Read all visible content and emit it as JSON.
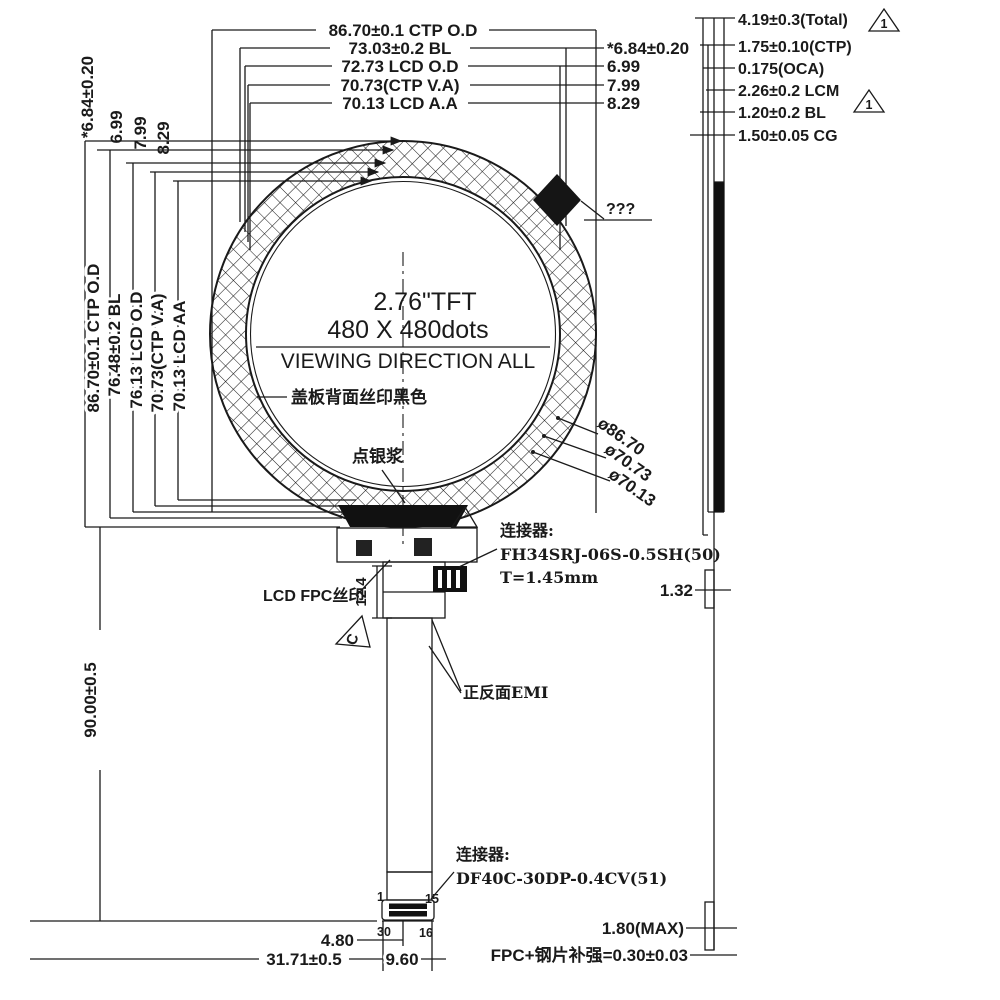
{
  "colors": {
    "ink": "#1a1a1a",
    "background": "#ffffff"
  },
  "front": {
    "top_dims": [
      "86.70±0.1 CTP O.D",
      "73.03±0.2 BL",
      "72.73 LCD O.D",
      "70.73(CTP V.A)",
      "70.13 LCD A.A"
    ],
    "right_offsets": [
      "*6.84±0.20",
      "6.99",
      "7.99",
      "8.29"
    ],
    "left_offsets": [
      "*6.84±0.20",
      "6.99",
      "7.99",
      "8.29"
    ],
    "left_dims": [
      "86.70±0.1 CTP O.D",
      "76.48±0.2 BL",
      "76.13 LCD O.D",
      "70.73(CTP V.A)",
      "70.13 LCD AA"
    ],
    "height_dim": "90.00±0.5",
    "display": {
      "size": "2.76\"TFT",
      "resolution": "480 X 480dots",
      "viewing_direction": "VIEWING DIRECTION ALL"
    },
    "notes": {
      "cover_print": "盖板背面丝印黑色",
      "silver_paste": "点银浆",
      "unknown": "???",
      "lcd_fpc_print": "LCD FPC丝印",
      "emi": "正反面EMI",
      "datum": "C"
    },
    "diameters": [
      "ø86.70",
      "ø70.73",
      "ø70.13"
    ],
    "fpc_length": "12.4",
    "top_connector": {
      "label": "连接器:",
      "part": "FH34SRJ-06S-0.5SH(50)",
      "height": "T=1.45mm"
    },
    "bottom_connector": {
      "label": "连接器:",
      "part": "DF40C-30DP-0.4CV(51)"
    },
    "pins": [
      "1",
      "15",
      "30",
      "16"
    ],
    "bottom_dims": {
      "pitch": "4.80",
      "width": "31.71±0.5",
      "conn_width": "9.60"
    }
  },
  "side": {
    "stack_dims": [
      "4.19±0.3(Total)",
      "1.75±0.10(CTP)",
      "0.175(OCA)",
      "2.26±0.2 LCM",
      "1.20±0.2 BL",
      "1.50±0.05 CG"
    ],
    "revision_flag": "1",
    "fpc_connector_height": "1.32",
    "max_height": "1.80(MAX)",
    "stiffener": "FPC+钢片补强=0.30±0.03"
  }
}
